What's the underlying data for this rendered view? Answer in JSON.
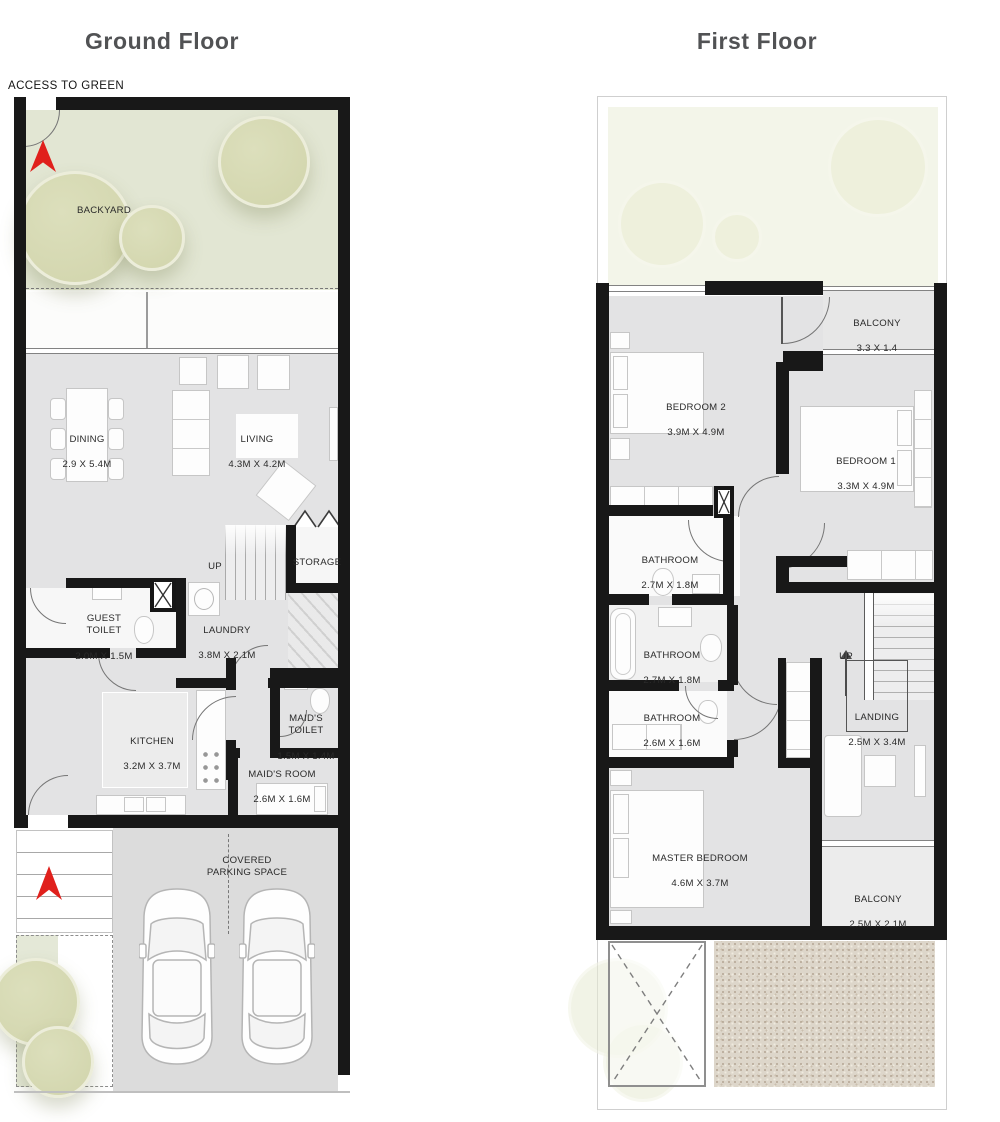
{
  "ground_floor": {
    "title": "Ground Floor",
    "access_label": "ACCESS TO  GREEN",
    "rooms": {
      "backyard": {
        "name": "BACKYARD"
      },
      "dining": {
        "name": "DINING",
        "dims": "2.9 X 5.4M"
      },
      "living": {
        "name": "LIVING",
        "dims": "4.3M X 4.2M"
      },
      "stairs": {
        "name": "UP"
      },
      "storage": {
        "name": "STORAGE"
      },
      "guest_toilet": {
        "name": "GUEST\nTOILET",
        "dims": "2.0M X 1.5M"
      },
      "laundry": {
        "name": "LAUNDRY",
        "dims": "3.8M X 2.1M"
      },
      "kitchen": {
        "name": "KITCHEN",
        "dims": "3.2M X 3.7M"
      },
      "maids_toilet": {
        "name": "MAID'S\nTOILET",
        "dims": "1.5M X 1.4M"
      },
      "maids_room": {
        "name": "MAID'S ROOM",
        "dims": "2.6M X 1.6M"
      },
      "parking": {
        "name": "COVERED\nPARKING SPACE"
      }
    }
  },
  "first_floor": {
    "title": "First Floor",
    "rooms": {
      "balcony_top": {
        "name": "BALCONY",
        "dims": "3.3 X 1.4"
      },
      "bedroom2": {
        "name": "BEDROOM 2",
        "dims": "3.9M X 4.9M"
      },
      "bedroom1": {
        "name": "BEDROOM 1",
        "dims": "3.3M X 4.9M"
      },
      "bathroom_top": {
        "name": "BATHROOM",
        "dims": "2.7M X 1.8M"
      },
      "bathroom_mid": {
        "name": "BATHROOM",
        "dims": "2.7M X 1.8M"
      },
      "bathroom_low": {
        "name": "BATHROOM",
        "dims": "2.6M X 1.6M"
      },
      "stairs": {
        "name": "UP"
      },
      "landing": {
        "name": "LANDING",
        "dims": "2.5M X 3.4M"
      },
      "master_bedroom": {
        "name": "MASTER BEDROOM",
        "dims": "4.6M X 3.7M"
      },
      "balcony_bottom": {
        "name": "BALCONY",
        "dims": "2.5M X 2.1M"
      }
    }
  },
  "colors": {
    "wall": "#181818",
    "floor_gray": "#e3e3e4",
    "backyard_green": "#e2e6d3",
    "tree_green": "#d6d9b2",
    "accent_red": "#e0201c",
    "title_gray": "#515254"
  }
}
